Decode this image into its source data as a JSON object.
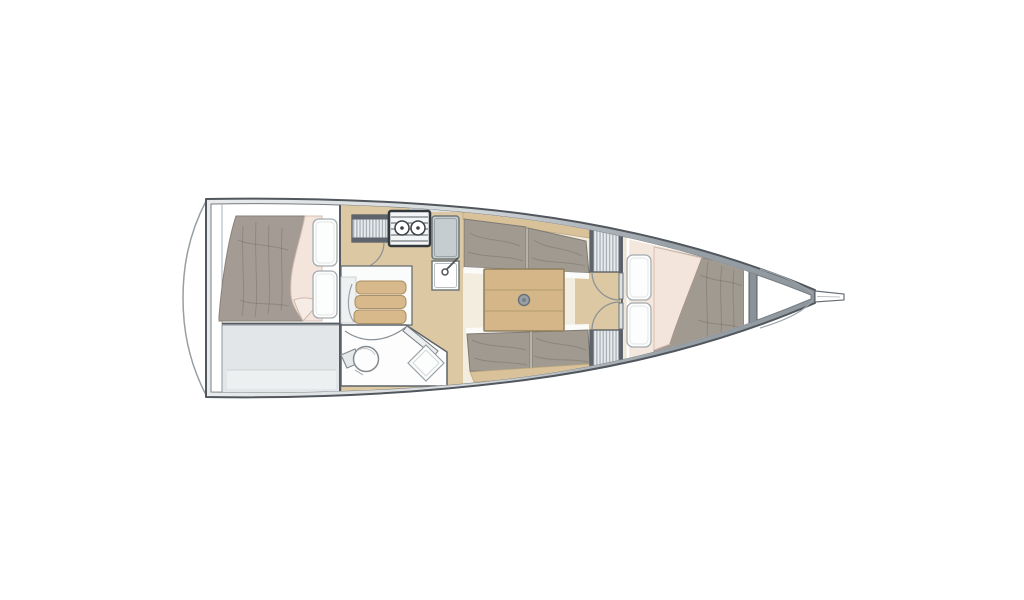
{
  "diagram": {
    "type": "sailboat-interior-floor-plan",
    "orientation": {
      "bow": "right",
      "stern": "left"
    },
    "areas": [
      {
        "id": "aft-cabin",
        "fixtures": [
          "double-berth",
          "mattress",
          "blanket",
          "pillow",
          "pillow"
        ]
      },
      {
        "id": "aft-storage",
        "fixtures": []
      },
      {
        "id": "companionway",
        "fixtures": [
          "steps",
          "cabin-door",
          "louver-locker"
        ]
      },
      {
        "id": "head",
        "fixtures": [
          "toilet",
          "shower-grate",
          "door"
        ]
      },
      {
        "id": "galley",
        "fixtures": [
          "stove",
          "counter-unit",
          "sink"
        ]
      },
      {
        "id": "salon",
        "fixtures": [
          "settee-port",
          "settee-starboard",
          "table",
          "table-pedestal"
        ]
      },
      {
        "id": "forward-cabin",
        "fixtures": [
          "louver-panel",
          "louver-panel",
          "double-doors",
          "v-berth",
          "pillow",
          "pillow",
          "duvet"
        ]
      },
      {
        "id": "bow-locker",
        "fixtures": [
          "anchor-locker-lines",
          "bow-fitting"
        ]
      }
    ]
  },
  "colors": {
    "page_bg": "#ffffff",
    "hull_outline": "#51575d",
    "hull_inner_line": "#767d82",
    "hull_band_light": "#e9ebec",
    "hull_band_mid": "#d5dadc",
    "hull_band_dark": "#99a1a8",
    "hull_band_bow": "#8d959c",
    "transom_line": "#989ea2",
    "bulkhead_line": "#555b60",
    "room_gray": "#e2e6e8",
    "floor_cream": "#f3eddf",
    "galley_sole": "#dcc8a2",
    "wood_step": "#d7b98c",
    "wood_backrest": "#d9c29a",
    "wood_table": "#d4b689",
    "wood_table_edge": "#8f7d5c",
    "mattress_gray": "#a49c94",
    "cushion_gray": "#a09a91",
    "blanket_pink": "#f3e4dc",
    "vberth_base": "#efe7da",
    "vberth_mattress": "#f4e8de",
    "pillow_white": "#fcfdfd",
    "pillow_edge": "#a6acb0",
    "stove_frame": "#33383e",
    "appliance_gray": "#c6cdcf",
    "fixture_edge": "#6e787b",
    "louver_bg": "#e8ecee",
    "louver_line": "#a7b0b6",
    "louver_cap": "#5d646b",
    "fwd_bulkhead": "#8a9298",
    "arc_line": "#8a9197",
    "detail_line": "#9aa1a6"
  }
}
